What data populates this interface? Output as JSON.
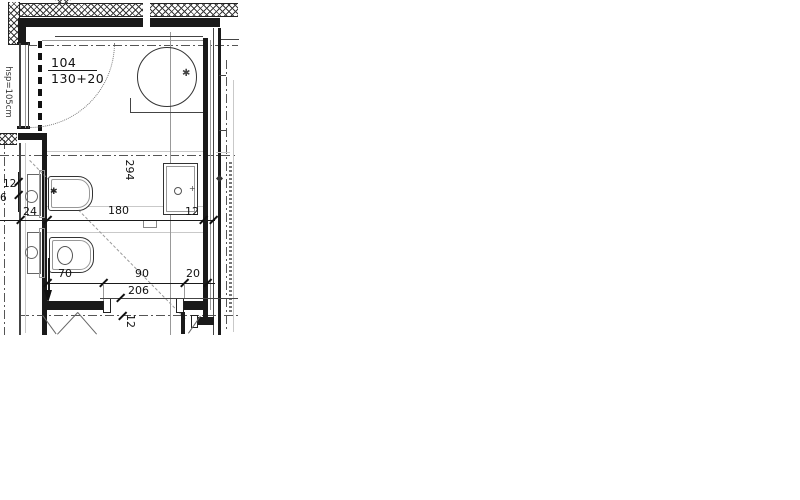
{
  "plan": {
    "door_tag": {
      "number": "104",
      "size": "130+20"
    },
    "window_label": "hsp=105cm",
    "dims": {
      "room_height": "294",
      "shaft_width": "24",
      "room_width": "180",
      "right_wall": "12",
      "left_upper": "12",
      "left_lower": "6",
      "seg1": "70",
      "seg2": "90",
      "seg3": "20",
      "door_total": "206",
      "bottom_wall": "12"
    },
    "fixture_icons": [
      "shower-tray-icon",
      "drain-icon",
      "bidet-icon",
      "toilet-icon",
      "washbasin-icon",
      "entry-arrow-icon"
    ]
  },
  "colors": {
    "line": "#1a1a1a",
    "thin": "#999999",
    "axis": "#555555",
    "bg": "#ffffff"
  }
}
